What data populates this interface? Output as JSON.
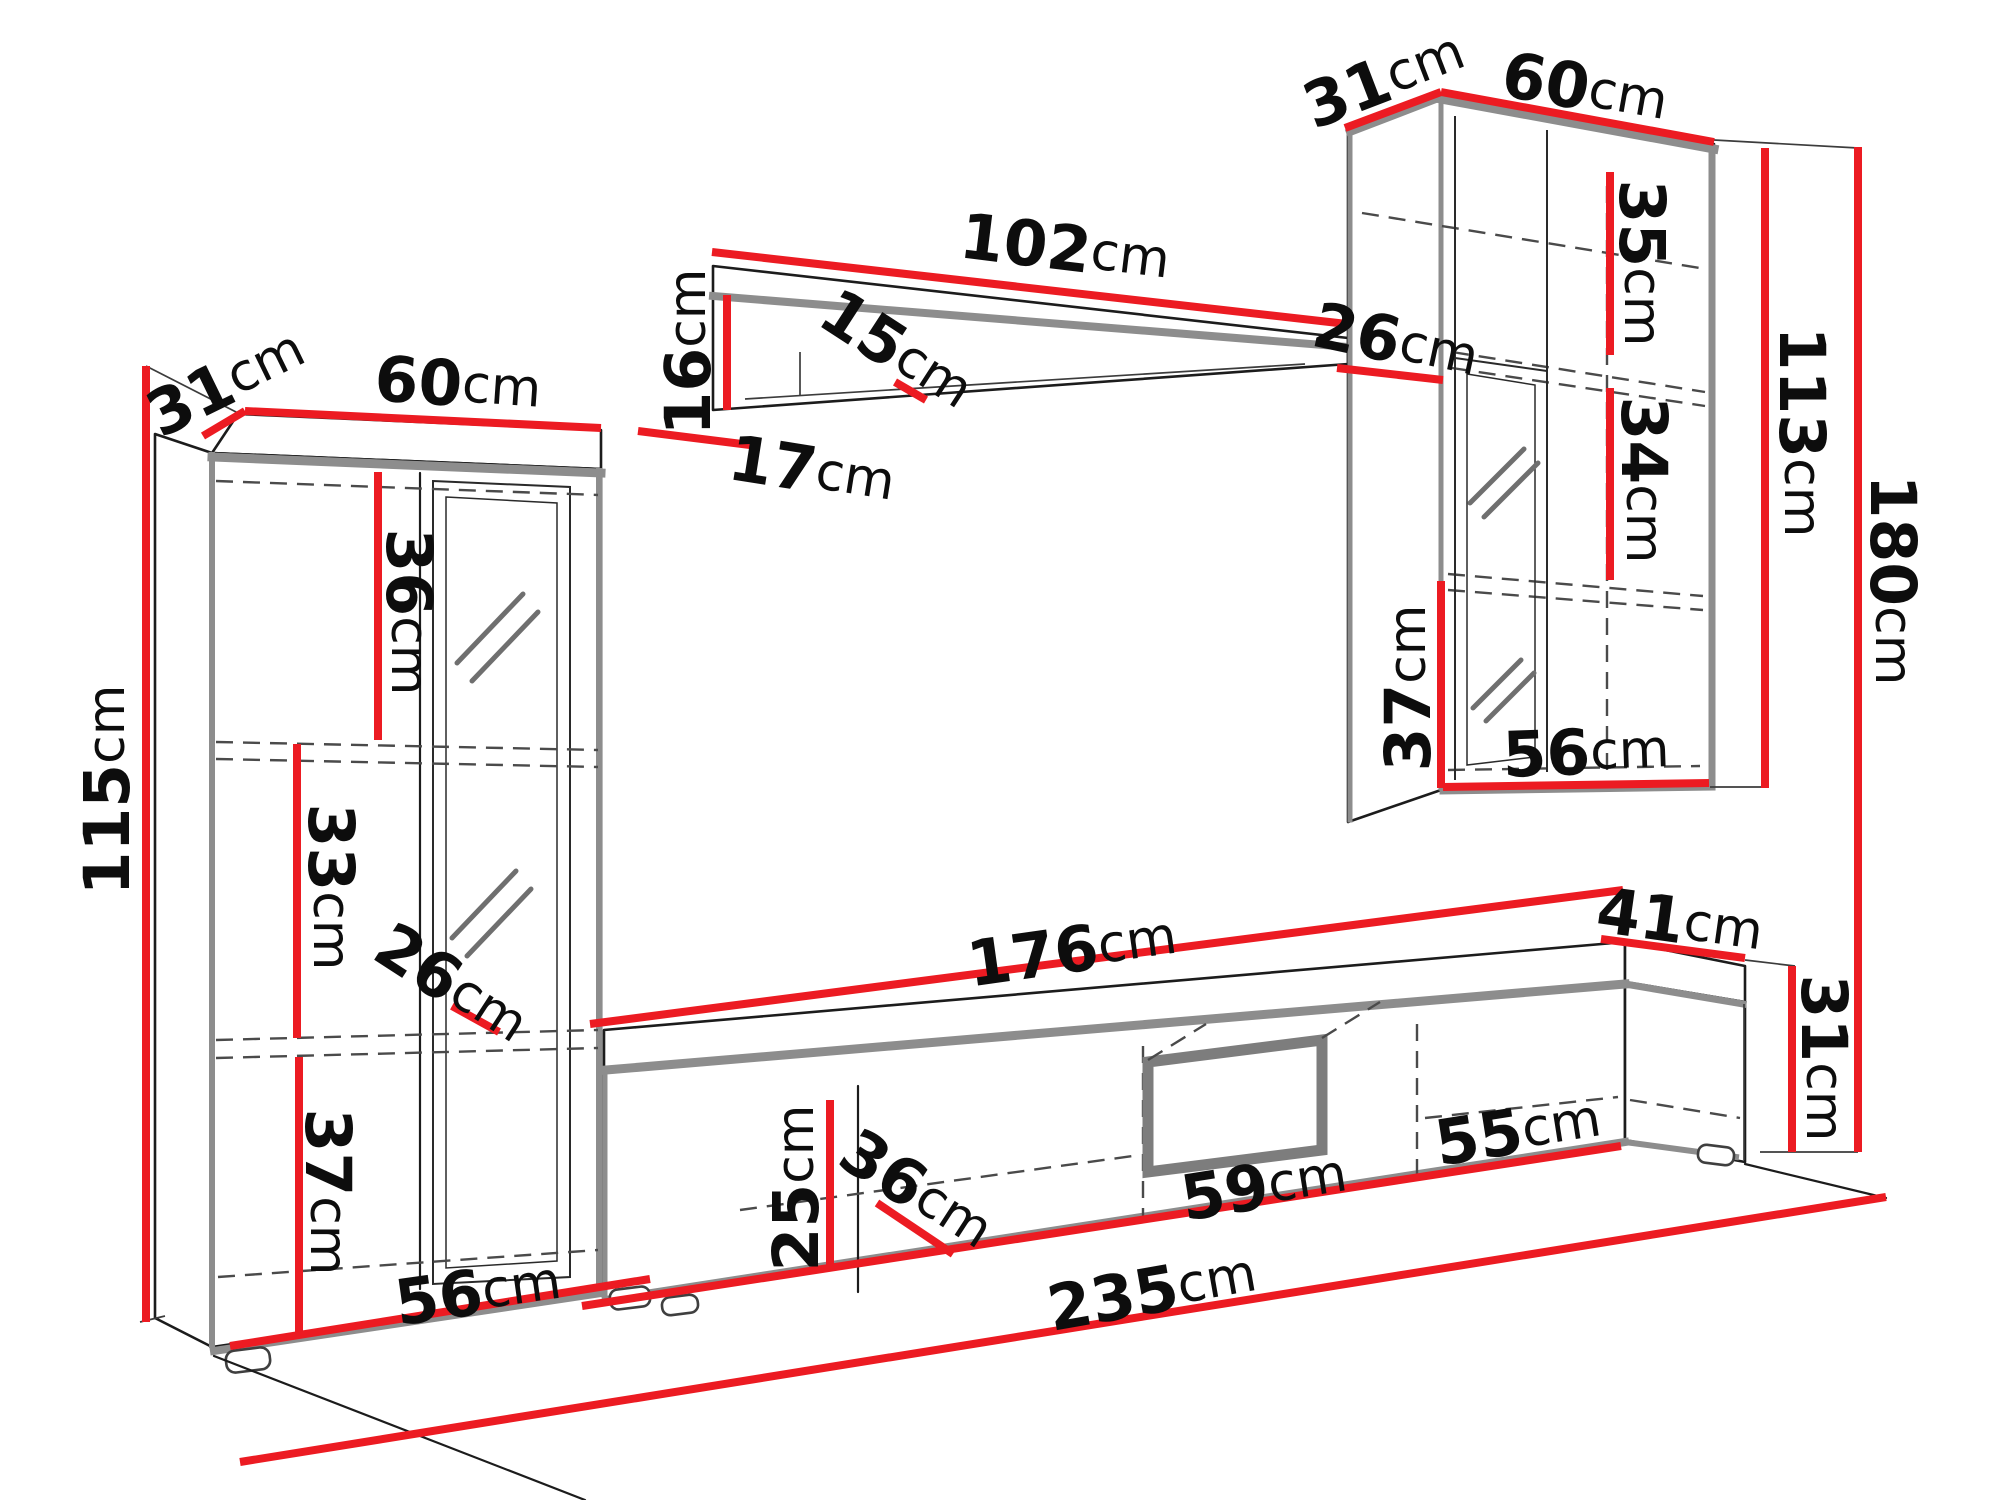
{
  "figure": {
    "kind": "furniture-dimension-diagram",
    "subject": "wall unit / entertainment center with dimension callouts",
    "unit_suffix": "cm"
  },
  "colors": {
    "dimension_line": "#ec1b22",
    "outline": "#1c1c1c",
    "accent_gray": "#8d8d8d",
    "dashed_gray": "#4a4a4a",
    "background": "#ffffff"
  },
  "dims": [
    {
      "id": "left-cabinet-depth",
      "value": "31",
      "unit": "cm"
    },
    {
      "id": "left-cabinet-width",
      "value": "60",
      "unit": "cm"
    },
    {
      "id": "left-cabinet-height",
      "value": "115",
      "unit": "cm"
    },
    {
      "id": "left-cabinet-top-section",
      "value": "36",
      "unit": "cm"
    },
    {
      "id": "left-cabinet-middle-section",
      "value": "33",
      "unit": "cm"
    },
    {
      "id": "left-cabinet-shelf-depth",
      "value": "26",
      "unit": "cm"
    },
    {
      "id": "left-cabinet-bottom-section",
      "value": "37",
      "unit": "cm"
    },
    {
      "id": "left-cabinet-interior-width",
      "value": "56",
      "unit": "cm"
    },
    {
      "id": "wall-shelf-width",
      "value": "102",
      "unit": "cm"
    },
    {
      "id": "wall-shelf-height",
      "value": "16",
      "unit": "cm"
    },
    {
      "id": "wall-shelf-inner-depth",
      "value": "15",
      "unit": "cm"
    },
    {
      "id": "wall-shelf-gap",
      "value": "17",
      "unit": "cm"
    },
    {
      "id": "right-cabinet-shelf-depth",
      "value": "26",
      "unit": "cm"
    },
    {
      "id": "right-cabinet-depth",
      "value": "31",
      "unit": "cm"
    },
    {
      "id": "right-cabinet-width",
      "value": "60",
      "unit": "cm"
    },
    {
      "id": "right-cabinet-top-section",
      "value": "35",
      "unit": "cm"
    },
    {
      "id": "right-cabinet-middle-section",
      "value": "34",
      "unit": "cm"
    },
    {
      "id": "right-cabinet-height",
      "value": "113",
      "unit": "cm"
    },
    {
      "id": "wall-unit-total-height",
      "value": "180",
      "unit": "cm"
    },
    {
      "id": "tv-stand-width",
      "value": "176",
      "unit": "cm"
    },
    {
      "id": "tv-stand-depth",
      "value": "41",
      "unit": "cm"
    },
    {
      "id": "tv-stand-height",
      "value": "31",
      "unit": "cm"
    },
    {
      "id": "tv-stand-interior-height",
      "value": "25",
      "unit": "cm"
    },
    {
      "id": "tv-stand-interior-depth",
      "value": "36",
      "unit": "cm"
    },
    {
      "id": "tv-stand-niche-width",
      "value": "59",
      "unit": "cm"
    },
    {
      "id": "tv-stand-right-section",
      "value": "55",
      "unit": "cm"
    },
    {
      "id": "total-width",
      "value": "235",
      "unit": "cm"
    },
    {
      "id": "right-cabinet-interior-width",
      "value": "56",
      "unit": "cm"
    },
    {
      "id": "right-cabinet-bottom-section",
      "value": "37",
      "unit": "cm"
    }
  ]
}
